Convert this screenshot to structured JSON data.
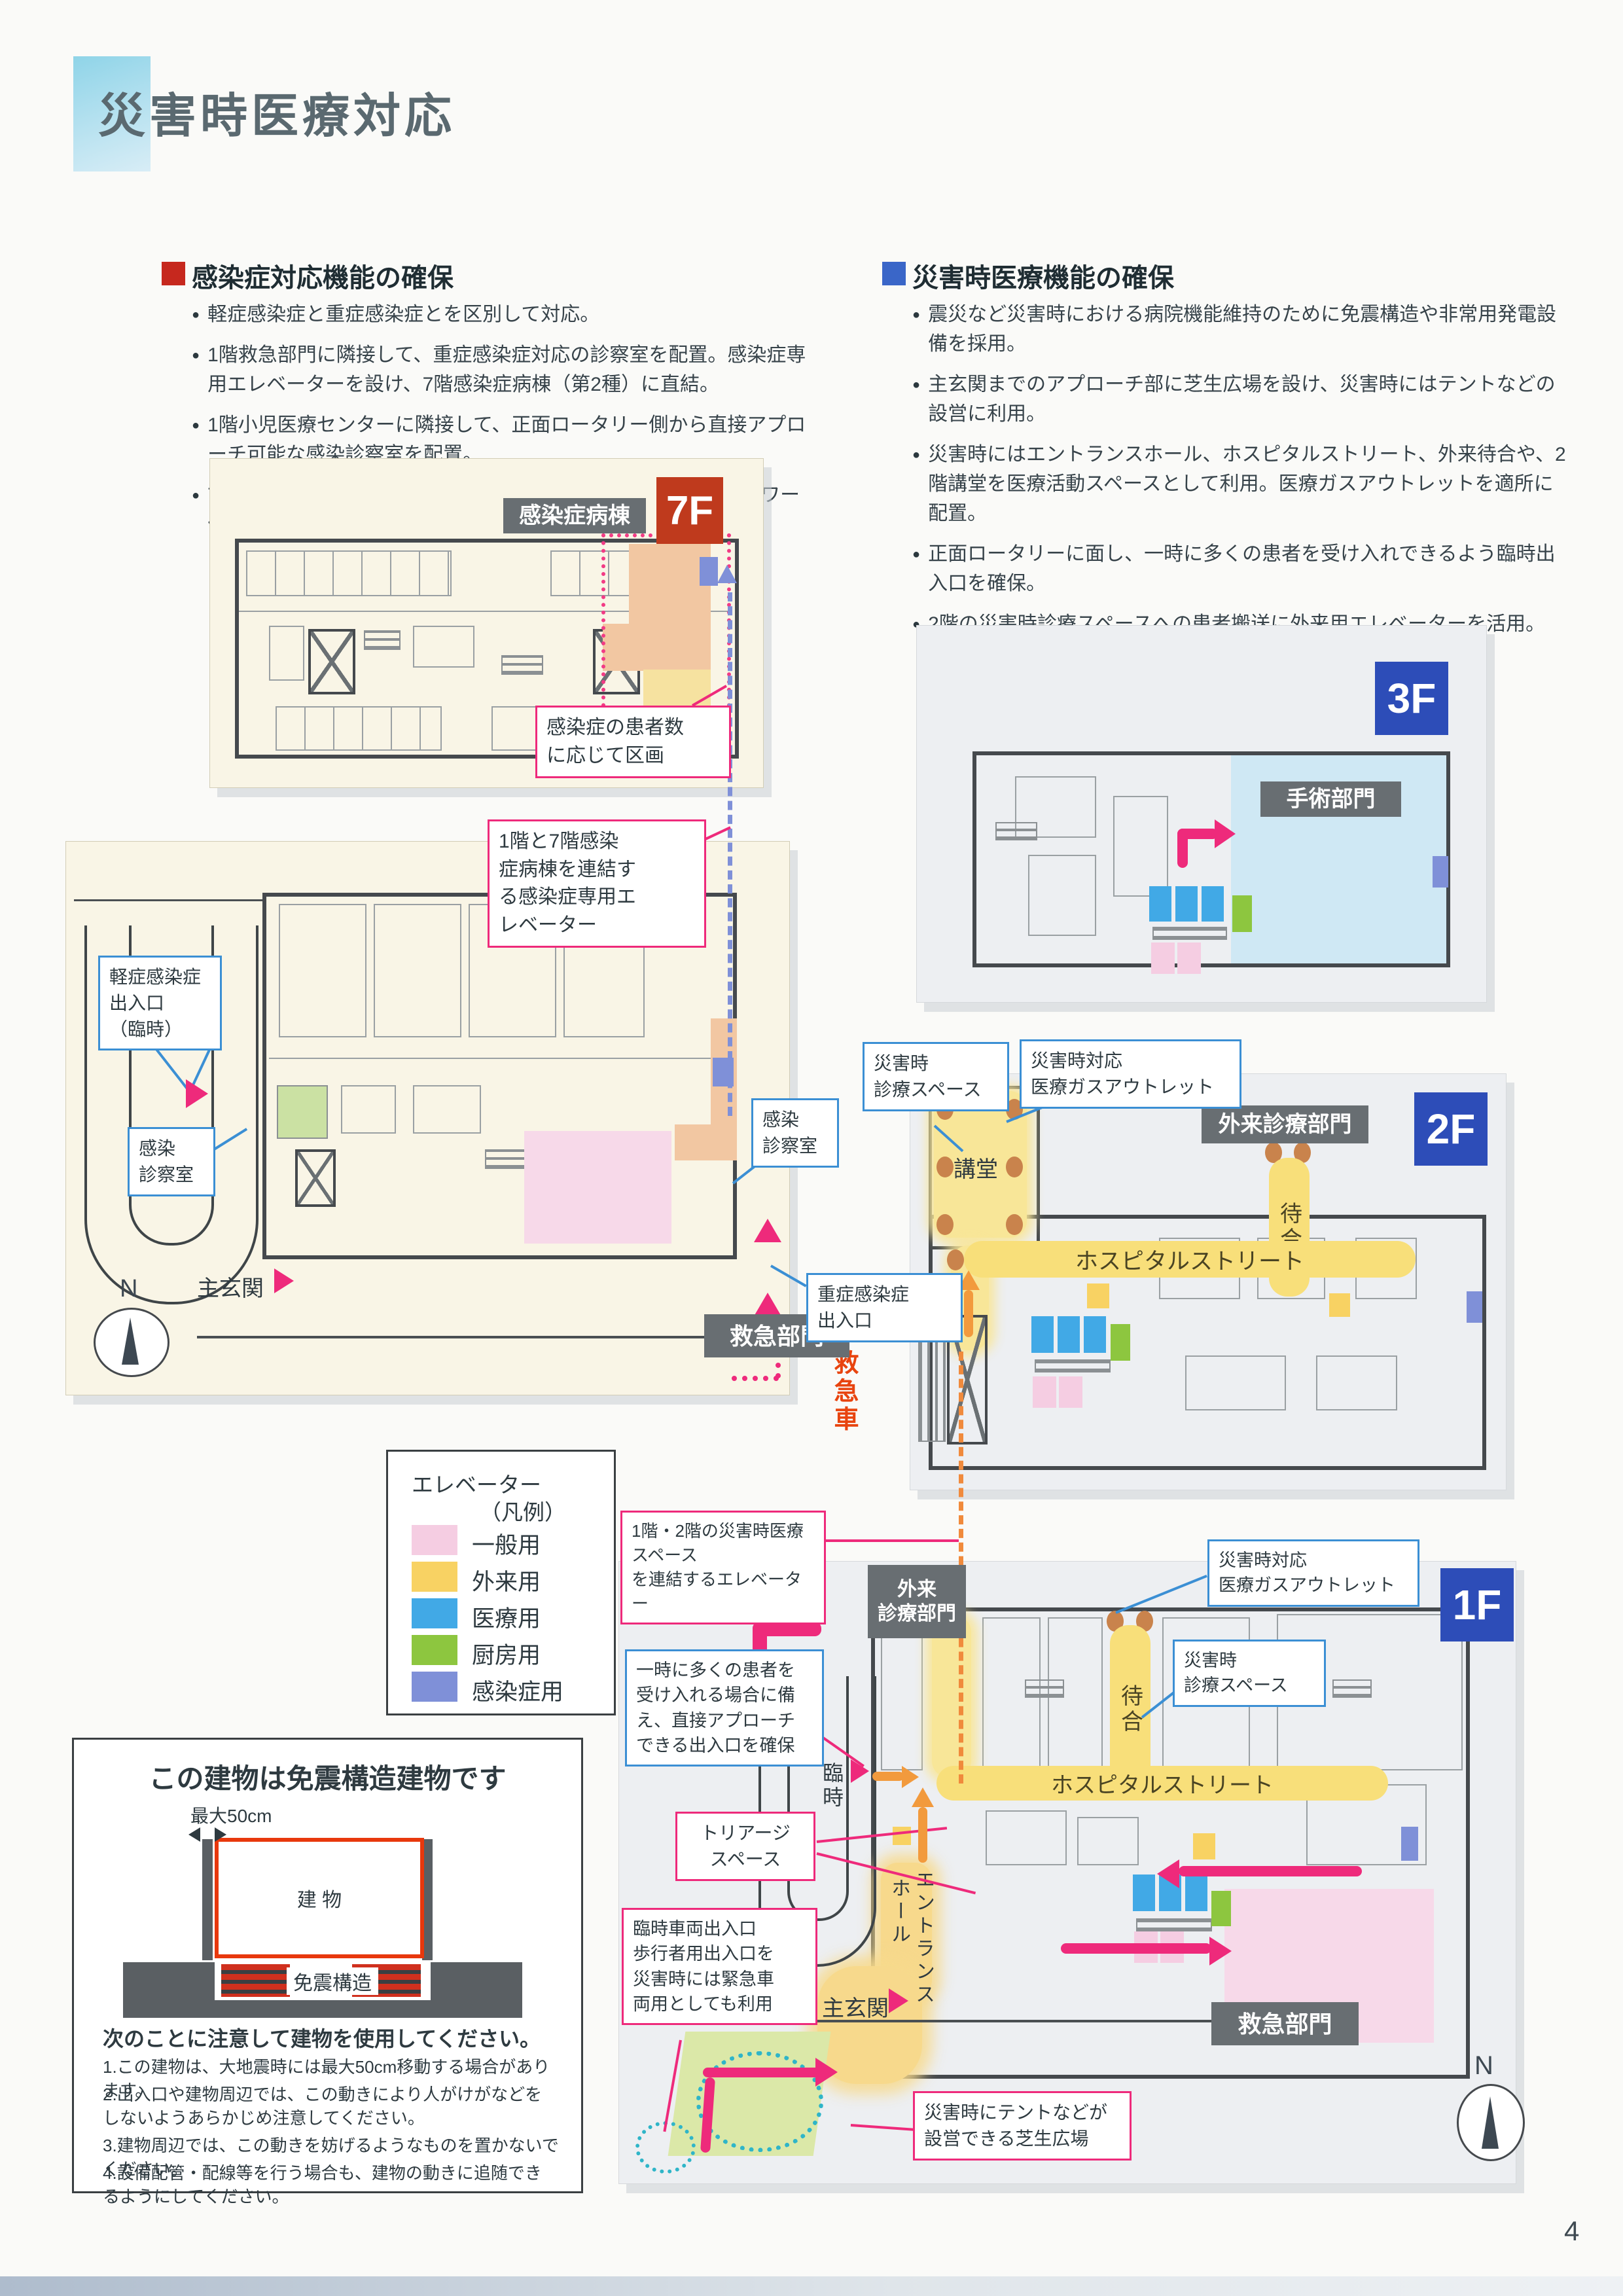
{
  "page": {
    "number": "4"
  },
  "title": "災害時医療対応",
  "sections": {
    "infection": {
      "heading": "感染症対応機能の確保",
      "bullets": [
        "軽症感染症と重症感染症とを区別して対応。",
        "1階救急部門に隣接して、重症感染症対応の診察室を配置。感染症専用エレベーターを設け、7階感染症病棟（第2種）に直結。",
        "1階小児医療センターに隣接して、正面ロータリー側から直接アプローチ可能な感染診察室を配置。",
        "7階に感染症病棟（第2種）を整備（8床）。病室はトイレ・シャワー付きの個室。"
      ]
    },
    "disaster": {
      "heading": "災害時医療機能の確保",
      "bullets": [
        "震災など災害時における病院機能維持のために免震構造や非常用発電設備を採用。",
        "主玄関までのアプローチ部に芝生広場を設け、災害時にはテントなどの設営に利用。",
        "災害時にはエントランスホール、ホスピタルストリート、外来待合や、2階講堂を医療活動スペースとして利用。医療ガスアウトレットを適所に配置。",
        "正面ロータリーに面し、一時に多くの患者を受け入れできるよう臨時出入口を確保。",
        "2階の災害時診療スペースへの患者搬送に外来用エレベーターを活用。"
      ]
    }
  },
  "plans": {
    "f7": {
      "badge": "7F",
      "ward": "感染症病棟",
      "callout": "感染症の患者数\nに応じて区画"
    },
    "f1a": {
      "badge": "1F",
      "elevator_callout": "1階と7階感染\n症病棟を連結す\nる感染症専用エ\nレベーター",
      "mild_entrance": "軽症感染症\n出入口\n（臨時）",
      "exam_room_left": "感染\n診察室",
      "exam_room_right": "感染\n診察室",
      "severe_entrance": "重症感染症\n出入口",
      "main_entrance": "主玄関",
      "er": "救急部門",
      "ambulance": "救急車",
      "compass": "N"
    },
    "f3": {
      "badge": "3F",
      "surgery": "手術部門"
    },
    "f2": {
      "badge": "2F",
      "outpatient": "外来診療部門",
      "space_callout": "災害時\n診療スペース",
      "gas_callout": "災害時対応\n医療ガスアウトレット",
      "hall": "講堂",
      "waiting": "待合",
      "street": "ホスピタルストリート"
    },
    "f1b": {
      "badge": "1F",
      "connect_callout": "1階・2階の災害時医療スペース\nを連結するエレベーター",
      "outpatient_1": "外来",
      "outpatient_2": "診療部門",
      "gas_callout": "災害時対応\n医療ガスアウトレット",
      "space_callout": "災害時\n診療スペース",
      "waiting": "待合",
      "street": "ホスピタルストリート",
      "temp": "臨時",
      "hall_1": "ホール",
      "hall_2": "エントランス",
      "direct_callout": "一時に多くの患者を\n受け入れる場合に備\nえ、直接アプローチ\nできる出入口を確保",
      "triage_callout": "トリアージ\nスペース",
      "vehicle_callout": "臨時車両出入口\n歩行者用出入口を\n災害時には緊急車\n両用としても利用",
      "main_entrance": "主玄関",
      "er": "救急部門",
      "lawn_callout": "災害時にテントなどが\n設営できる芝生広場",
      "compass": "N"
    }
  },
  "legend": {
    "title": "エレベーター",
    "subtitle": "（凡例）",
    "items": [
      {
        "label": "一般用",
        "color": "#f5cde2"
      },
      {
        "label": "外来用",
        "color": "#f8d263"
      },
      {
        "label": "医療用",
        "color": "#41a9e6"
      },
      {
        "label": "厨房用",
        "color": "#8dc63f"
      },
      {
        "label": "感染症用",
        "color": "#7f90d8"
      }
    ]
  },
  "seismic": {
    "title": "この建物は免震構造建物です",
    "max": "最大50cm",
    "building": "建 物",
    "isolation": "免震構造",
    "note_title": "次のことに注意して建物を使用してください。",
    "notes": [
      "1.この建物は、大地震時には最大50cm移動する場合があります。",
      "2.出入口や建物周辺では、この動きにより人がけがなどをしないようあらかじめ注意してください。",
      "3.建物周辺では、この動きを妨げるようなものを置かないでください。",
      "4.設備配管・配線等を行う場合も、建物の動きに追随できるようにしてください。"
    ]
  },
  "colors": {
    "accent_pink": "#ee2a7b",
    "accent_orange": "#f08a3c",
    "badge_red": "#bf3a1d",
    "badge_blue": "#2d4db8",
    "badge_gray": "#686e72",
    "dashed_blue": "#7f90d8"
  }
}
